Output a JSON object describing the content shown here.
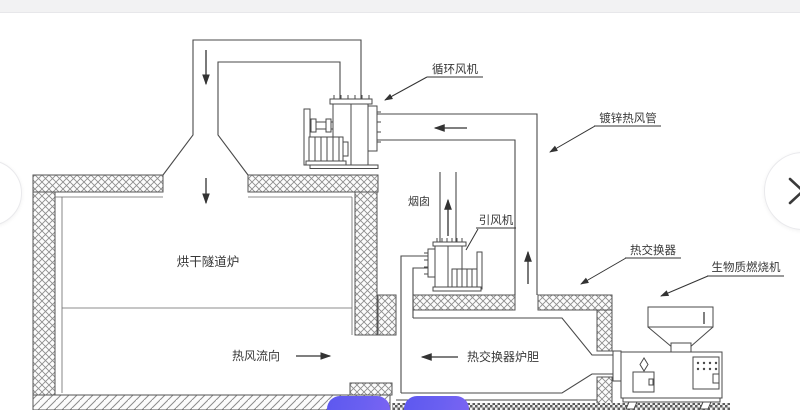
{
  "diagram": {
    "labels": {
      "circulation_fan": "循环风机",
      "galvanized_pipe": "镀锌热风管",
      "chimney": "烟囱",
      "draft_fan": "引风机",
      "heat_exchanger": "热交换器",
      "biomass_burner": "生物质燃烧机",
      "furnace": "烘干隧道炉",
      "hot_air_flow": "热风流向",
      "liner": "热交换器炉胆"
    },
    "line_color": "#4a4a4a",
    "wall_pattern": "cross-hatch",
    "floor_pattern": "diagonal-hatch"
  },
  "carousel": {
    "prev_icon": "chevron-left",
    "next_icon": "chevron-right"
  },
  "overlay": {
    "topbar_color": "#f2f2f3",
    "pill_color_start": "#5d58ef",
    "pill_color_end": "#7b64f2"
  }
}
